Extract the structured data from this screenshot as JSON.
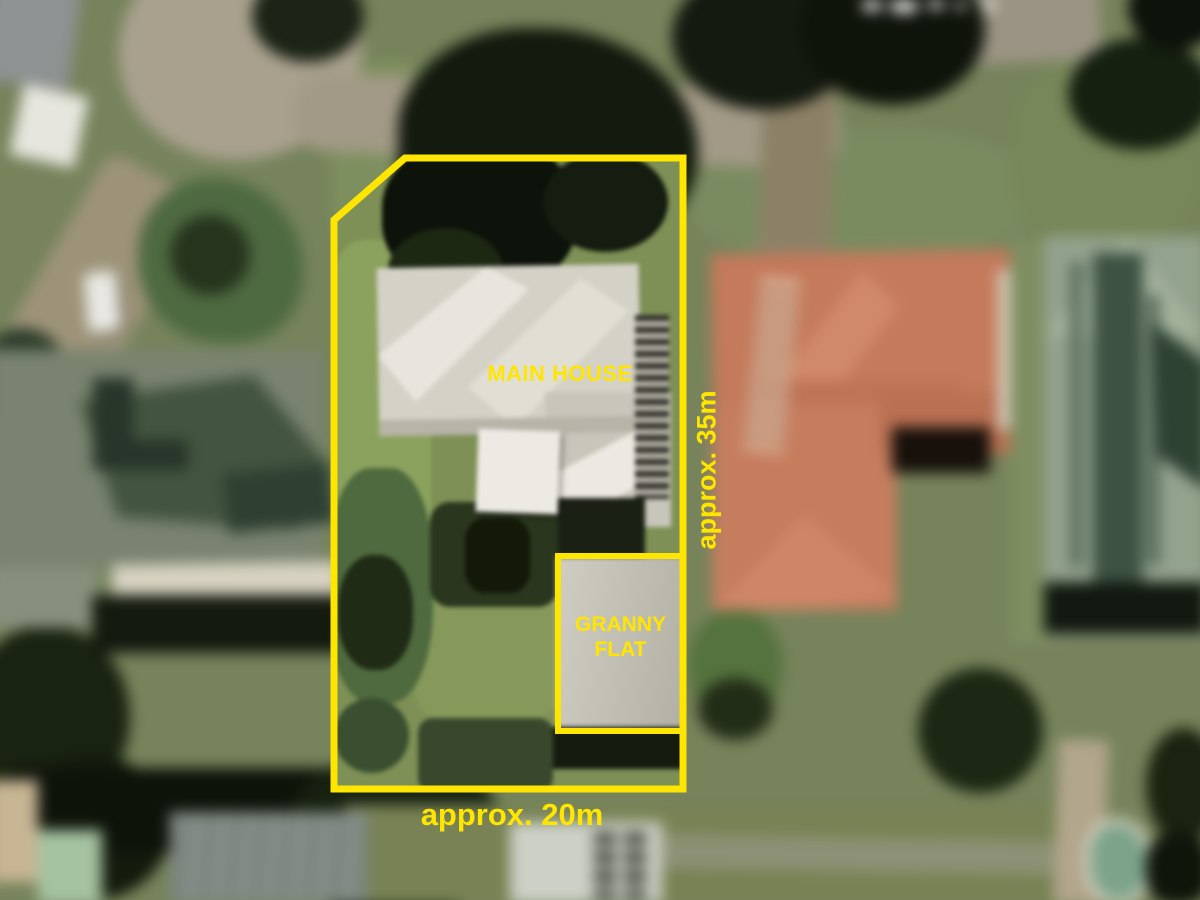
{
  "overlay": {
    "accent_color": "#FFE600",
    "labels": {
      "main_house": "MAIN HOUSE",
      "granny_flat": "GRANNY FLAT",
      "width": "approx. 20m",
      "depth": "approx. 35m"
    },
    "property_boundary_points": "405,158 683,158 683,789 334,789 334,220",
    "granny_flat_boundary_points": "558,556 683,556 683,731 558,731"
  }
}
